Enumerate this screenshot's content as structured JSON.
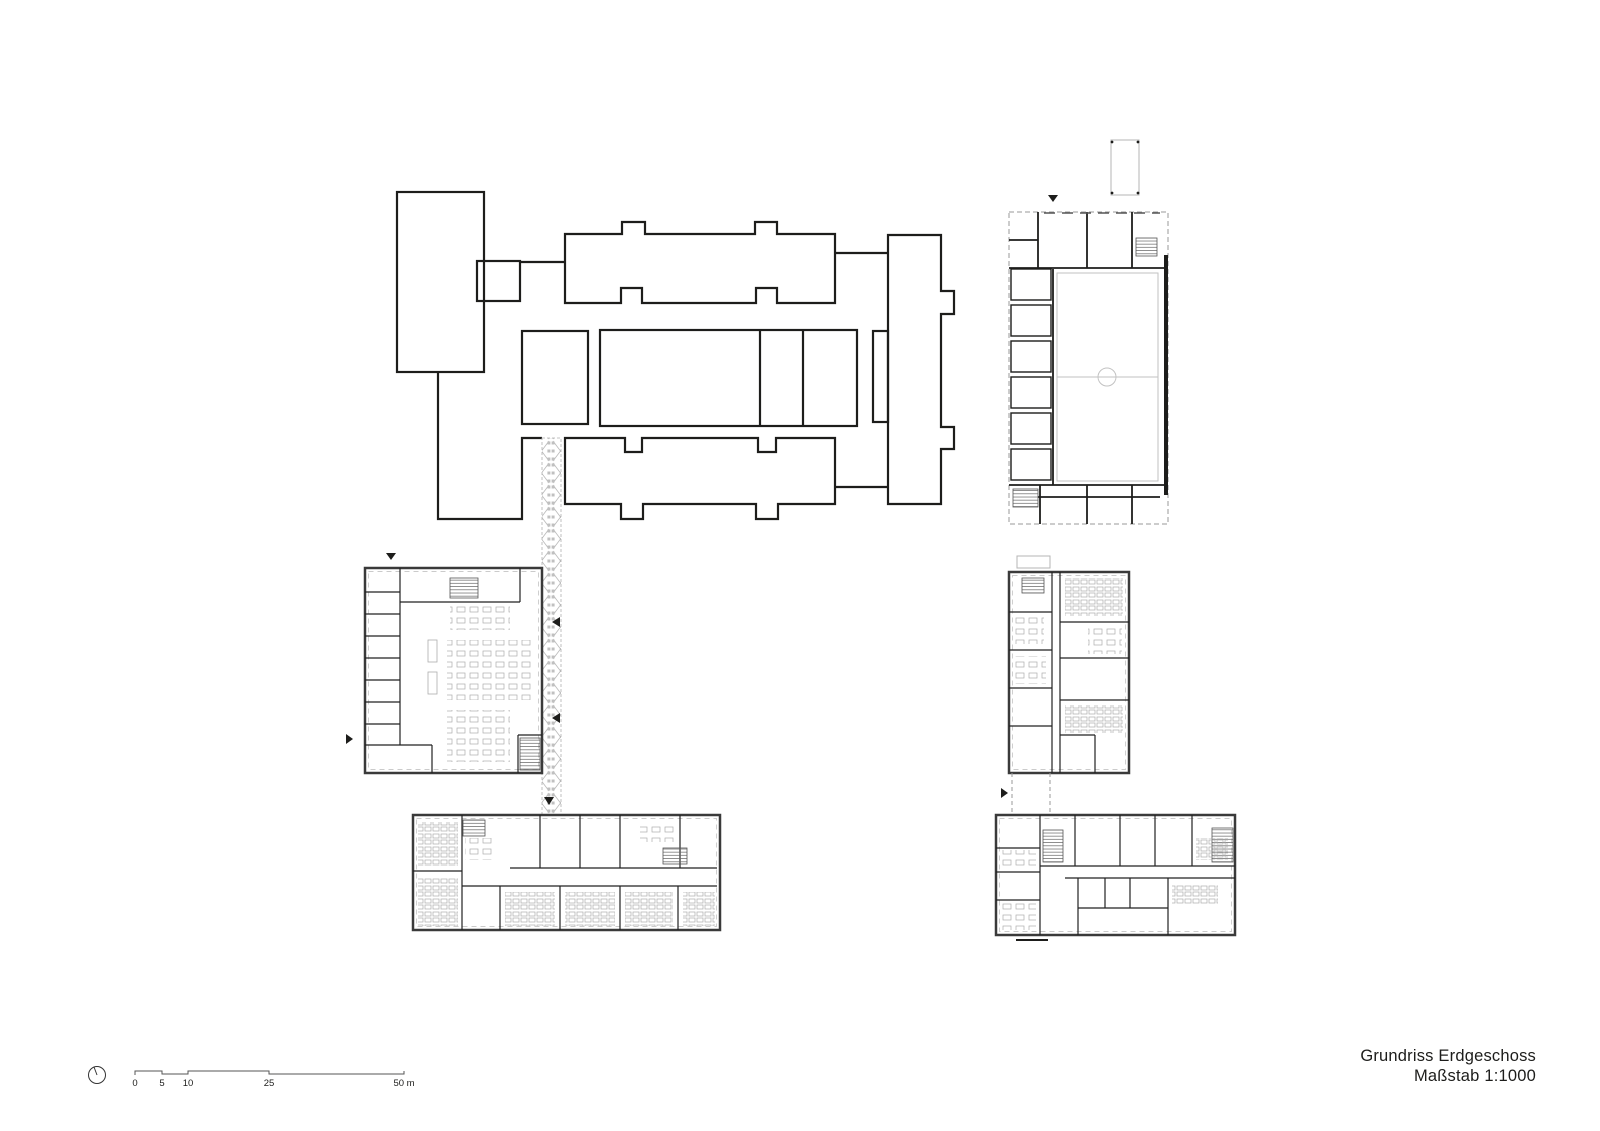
{
  "document": {
    "title": "Grundriss Erdgeschoss",
    "scale_label": "Maßstab 1:1000"
  },
  "scale_bar": {
    "unit_labels": [
      "0",
      "5",
      "10",
      "25",
      "50 m"
    ]
  },
  "colors": {
    "background": "#ffffff",
    "line_black": "#1d1d1b",
    "wall_dark_gray": "#3a3a3a",
    "furniture_gray": "#adadad",
    "hatch_gray": "#b0b0b0",
    "field_gray": "#c2c2c2"
  }
}
